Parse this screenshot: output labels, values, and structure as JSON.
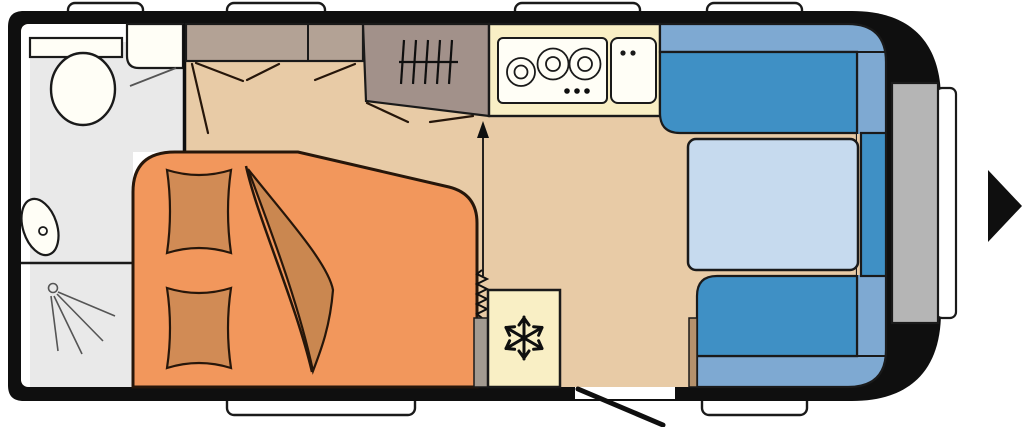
{
  "title": "caravan-floorplan",
  "plan": {
    "windows_top": 4,
    "windows_bottom": 2,
    "direction_arrow": "right"
  },
  "icons": {
    "snowflake-icon": "❄ refrigerator",
    "hanger-icon": "wardrobe rails",
    "shower-spray-icon": "shower",
    "direction-arrow-icon": "travel direction right",
    "heater-icon": "heater coil with warm-air arrow",
    "door-swing-icon": "entry door swing"
  },
  "palette": {
    "body": "#0f0f0f",
    "outline": "#1a1a1a",
    "bedOutline": "#26160a",
    "floor": "#e8cba6",
    "bathroomFloor": "#e9e9e9",
    "white": "#ffffff",
    "fixtureWhite": "#fffef6",
    "bedOrange": "#f2975c",
    "cushionOrange": "#d18b55",
    "blanketOrange": "#ca8750",
    "cabinetLight": "#b3a295",
    "wardrobeDark": "#a2918a",
    "kitchenCream": "#f9efc5",
    "seatBlue": "#3f90c5",
    "seatLightBlue": "#7ea9d2",
    "tableBlue": "#c6daee",
    "panelGray": "#b5b5b5",
    "heaterGray": "#a39b91",
    "shelfBrown": "#b5916c",
    "sprayGray": "#555555"
  }
}
